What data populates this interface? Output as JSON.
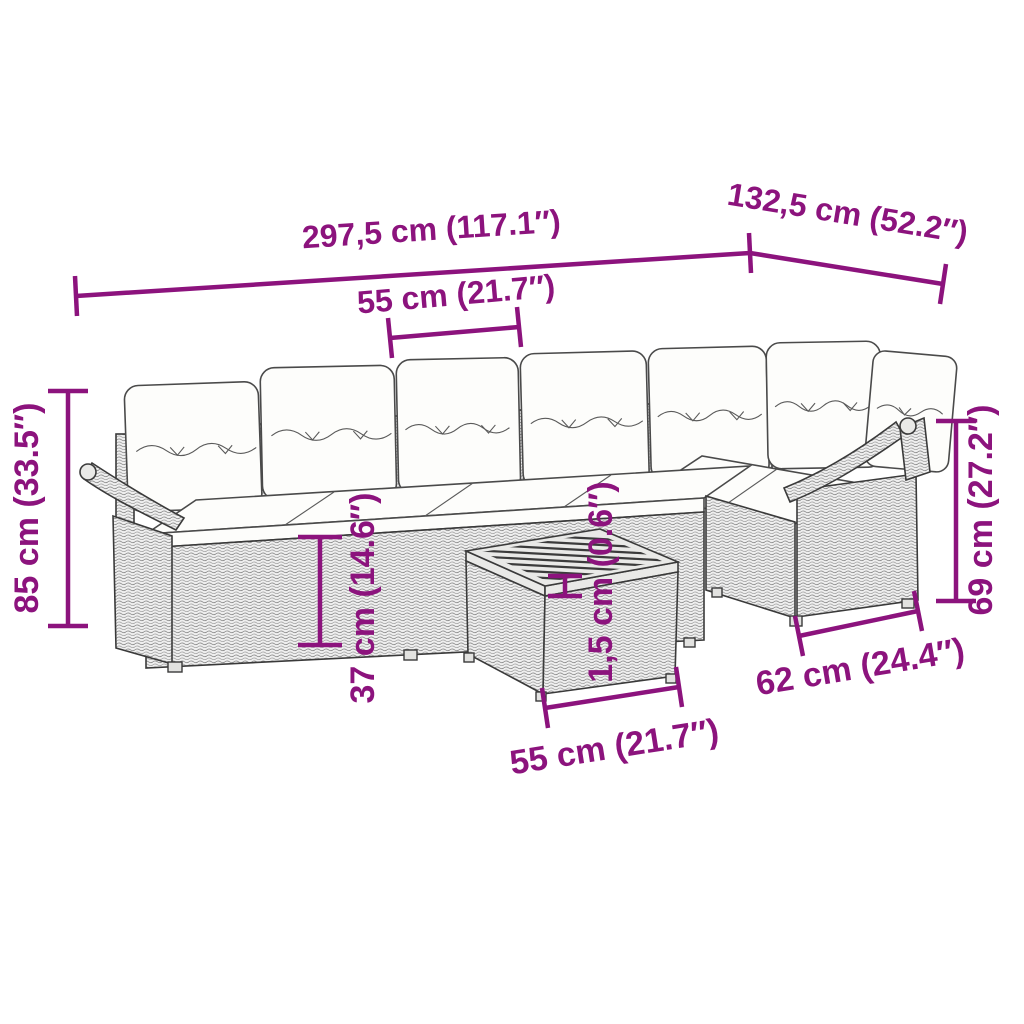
{
  "page": {
    "background_color": "#ffffff"
  },
  "figure": {
    "type": "product-dimension-line-art",
    "subject": "rattan-corner-sofa-set-with-cushions-and-slatted-table",
    "colors": {
      "dimension_annotation": "#8C137D",
      "line_art": "#3a3a3a",
      "rattan_fill": "#efefef",
      "cushion_fill": "#fdfdfb"
    }
  },
  "dimensions": {
    "overall_width": {
      "label": "297,5 cm (117.1″)"
    },
    "overall_depth": {
      "label": "132,5 cm (52.2″)"
    },
    "seat_width": {
      "label": "55 cm (21.7″)"
    },
    "overall_height": {
      "label": "85 cm (33.5″)"
    },
    "seat_height": {
      "label": "37 cm (14.6″)"
    },
    "tabletop_thickness": {
      "label": "1,5 cm (0.6″)"
    },
    "arm_height": {
      "label": "69 cm (27.2″)"
    },
    "module_depth": {
      "label": "62 cm (24.4″)"
    },
    "table_width": {
      "label": "55 cm (21.7″)"
    }
  }
}
